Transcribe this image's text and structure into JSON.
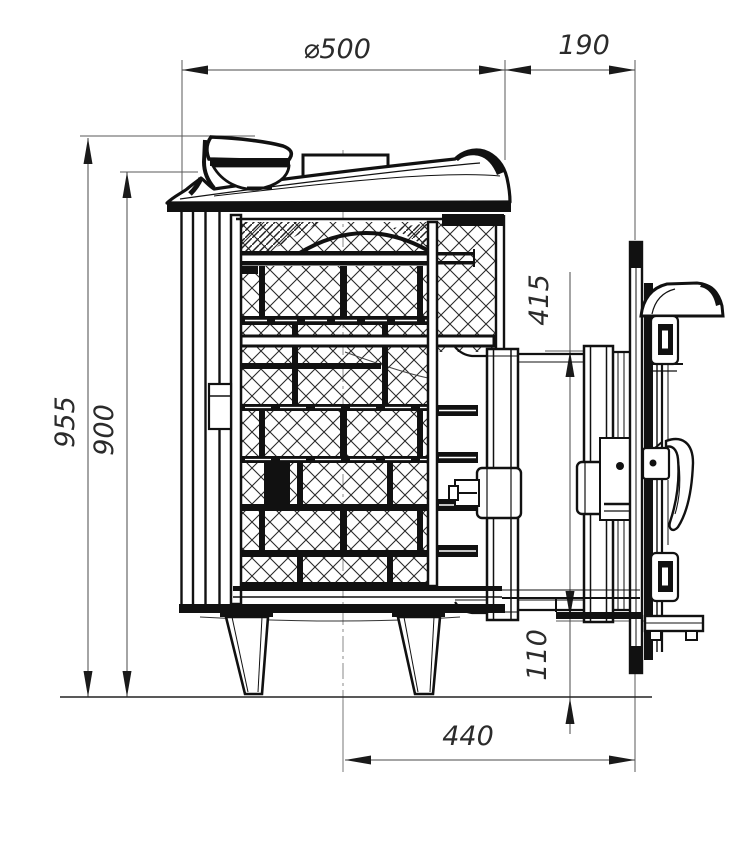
{
  "drawing": {
    "kind": "stove-side-view-technical-drawing",
    "dimensions": {
      "d500": "⌀500",
      "d190": "190",
      "d955": "955",
      "d900": "900",
      "d415": "415",
      "d110": "110",
      "d440": "440"
    },
    "colors": {
      "background": "#ffffff",
      "part_lines": "#151515",
      "dimension_lines": "#4a4a4a",
      "label_text": "#2b2b2b",
      "hatch": "#2a2a2a"
    }
  }
}
